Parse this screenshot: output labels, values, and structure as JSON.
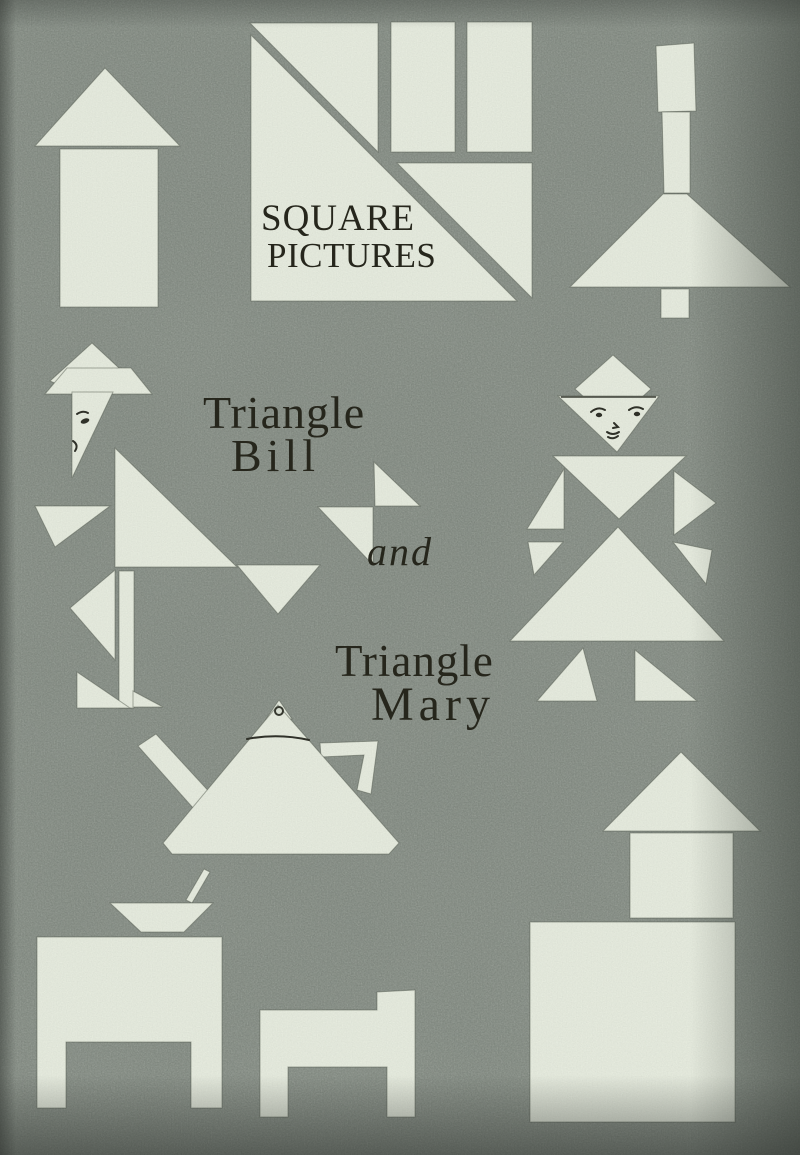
{
  "page_type": "scanned-book-plate",
  "title": {
    "line1": "SQUARE",
    "line2": "PICTURES"
  },
  "captions": {
    "bill_line1": "Triangle",
    "bill_line2": "Bill",
    "conjunction": "and",
    "mary_line1": "Triangle",
    "mary_line2": "Mary"
  },
  "figures": [
    {
      "name": "arrow-figure",
      "depicts": "upward arrow made of triangle and rectangle"
    },
    {
      "name": "title-square-figure",
      "depicts": "large square cut into triangles and rectangles around the title"
    },
    {
      "name": "funnel-figure",
      "depicts": "funnel or lamp of rectangles and a triangle"
    },
    {
      "name": "triangle-bill-figure",
      "depicts": "boy figure assembled from triangles with drawn profile face"
    },
    {
      "name": "triangle-mary-figure",
      "depicts": "girl figure assembled from triangles with drawn face"
    },
    {
      "name": "teapot-figure",
      "depicts": "teapot with spout, handle and lid knob"
    },
    {
      "name": "table-with-bowl-figure",
      "depicts": "table with bowl and spoon on top"
    },
    {
      "name": "chair-figure",
      "depicts": "small chair in side view"
    },
    {
      "name": "house-figure",
      "depicts": "house of square, block and triangle roof"
    }
  ],
  "colors": {
    "paper": "#e9eee1",
    "background": "#8b938a",
    "ink": "#26261c"
  }
}
